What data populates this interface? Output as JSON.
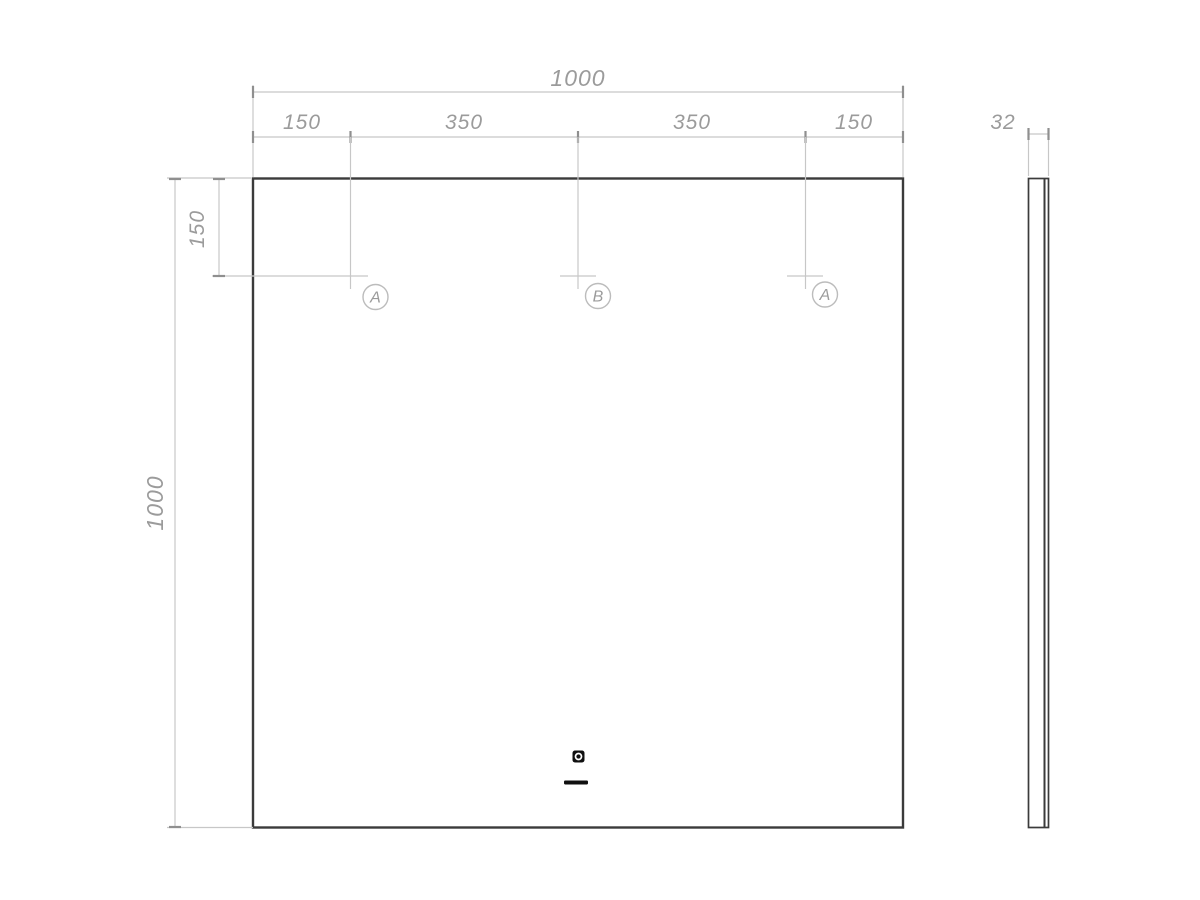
{
  "front_view": {
    "overall_width": "1000",
    "overall_height": "1000",
    "top_segments": [
      "150",
      "350",
      "350",
      "150"
    ],
    "hole_top_offset": "150",
    "hole_markers": [
      "A",
      "B",
      "A"
    ]
  },
  "side_view": {
    "depth": "32"
  },
  "icons": {
    "touch_sensor": "touch-sensor-icon",
    "indicator_dash": "indicator-dash-icon"
  },
  "colors": {
    "outline": "#3b3b3b",
    "dimension_line": "#c7c7c7",
    "tick": "#8f8f8f",
    "dimension_text": "#9b9b9b",
    "icon": "#101010"
  }
}
